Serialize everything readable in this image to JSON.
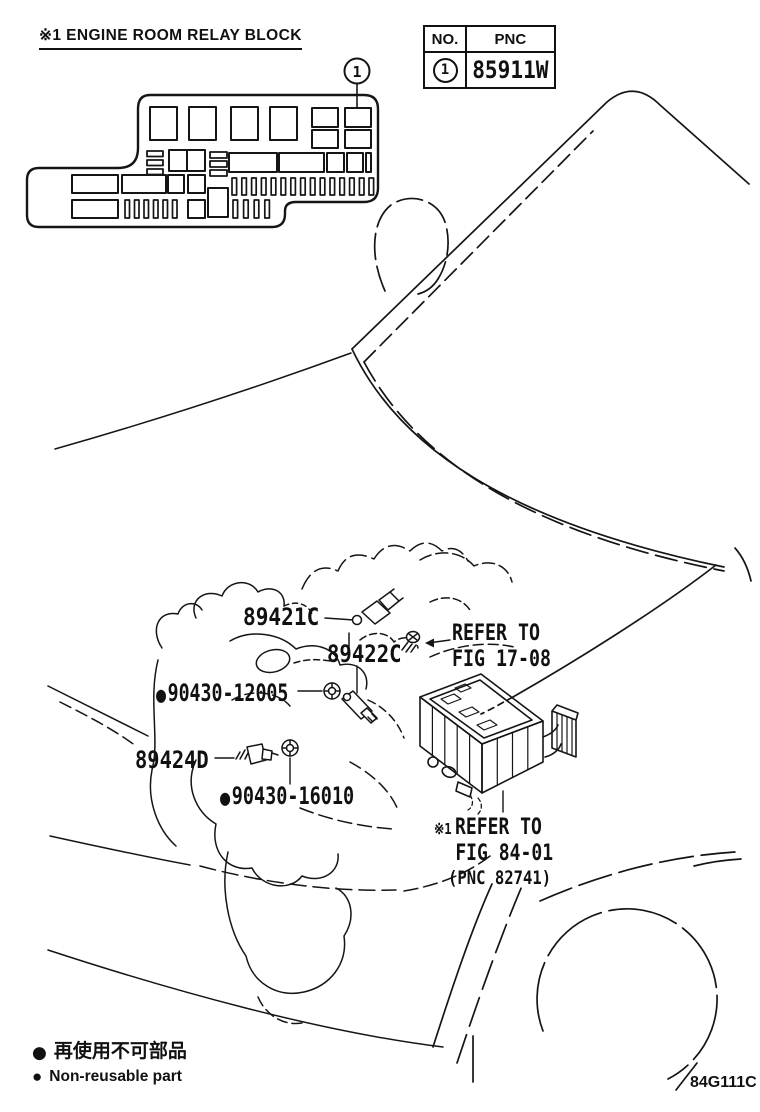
{
  "header": {
    "note": "※1 ENGINE ROOM RELAY BLOCK"
  },
  "pnc_table": {
    "headers": {
      "no": "NO.",
      "pnc": "PNC"
    },
    "row": {
      "no": "1",
      "pnc": "85911W"
    }
  },
  "relay_block_detail": {
    "callout_number": "1"
  },
  "callouts": {
    "p89421c": {
      "label": "89421C"
    },
    "p89422c": {
      "label": "89422C"
    },
    "p90430_12005": {
      "label": "90430-12005",
      "non_reusable": true
    },
    "p89424d": {
      "label": "89424D"
    },
    "p90430_16010": {
      "label": "90430-16010",
      "non_reusable": true
    },
    "refer_fig_17_08": {
      "line1": "REFER TO",
      "line2": "FIG 17-08"
    },
    "refer_fig_84_01": {
      "note_mark": "※1",
      "line1": "REFER TO",
      "line2": "FIG 84-01",
      "line3": "(PNC 82741)"
    }
  },
  "icons": {
    "non_reusable_bullet": "●"
  },
  "legend": {
    "jp": "再使用不可部品",
    "en": "Non-reusable part"
  },
  "figure_code": "84G111C",
  "colors": {
    "ink": "#111111",
    "bg": "#ffffff"
  }
}
